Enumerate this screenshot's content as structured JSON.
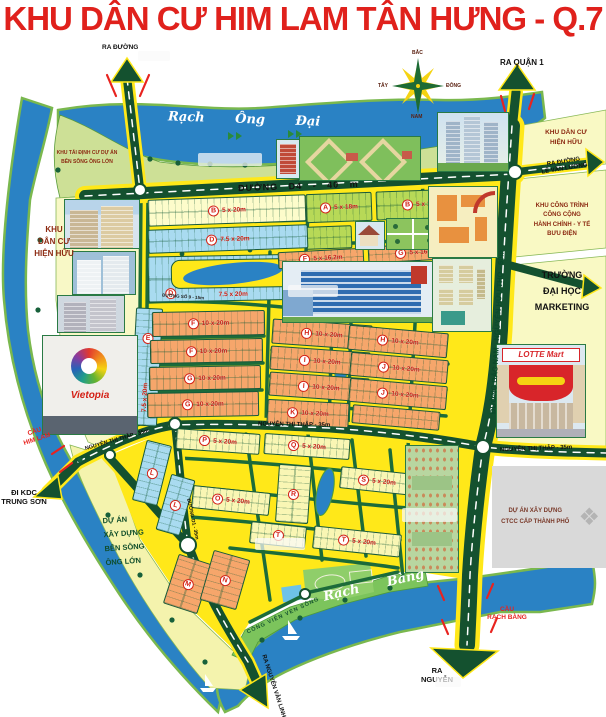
{
  "title": "KHU DÂN CƯ HIM LAM TÂN HƯNG - Q.7",
  "colors": {
    "title_red": "#e0211c",
    "water": "#2a82c4",
    "road_yellow": "#ffe819",
    "road_green": "#14512f",
    "land_green": "#cde096",
    "zone_pale": "#f9f9c4",
    "block_orange": "#f6a66b",
    "block_blue": "#a9dbf0",
    "block_green": "#b7d957"
  },
  "compass": {
    "n": "BẮC",
    "s": "NAM",
    "w": "TÂY",
    "e": "ĐÔNG"
  },
  "waterways": {
    "rach_ong_dai": "Rạch Ông Đại",
    "song_ong_lon": "Sông Ông Lớn",
    "rach_bang": "Rạch Bàng"
  },
  "roads": {
    "d4": "ĐƯỜNG D4 - 40 m",
    "bac_nam": "ĐƯỜNG BẮC NAM - NGUYỄN HỮU THỌ - 60m",
    "ntt": "NGUYỄN THỊ THẬP - 35m",
    "d1": "ĐƯỜNG D1 - 35m",
    "so9": "ĐƯỜNG SỐ 9 - 15m"
  },
  "exits": {
    "quan1": "RA QUẬN 1",
    "lvl": "RA ĐƯỜNG\nLÊ VĂN LƯƠNG",
    "top_left": "RA ĐƯỜNG",
    "kdc_trung_son": "ĐI KDC\nTRUNG SƠN",
    "nvl": "RA NGUYỄN VĂN LINH",
    "nguyen": "RA\nNGUYỄN"
  },
  "bridges": {
    "him_lam": "CẦU\nHIM LAM",
    "rach_bang": "CẦU\nRẠCH BÀNG"
  },
  "areas": {
    "hien_huu_left": "KHU\nDÂN CƯ\nHIỆN HỮU",
    "hien_huu_tr": "KHU DÂN CƯ\nHIỆN HỮU",
    "tai_dinh_cu": "KHU TÁI ĐỊNH CƯ DỰ ÁN\nBÊN SÔNG ÔNG LỚN",
    "cong_trinh": "KHU CÔNG TRÌNH\nCÔNG CỘNG\nHÀNH CHÍNH - Y TẾ\nBƯU ĐIỆN",
    "truong": "TRƯỜNG\nĐẠI HỌC\nMARKETING",
    "du_an_ben_song": "DỰ ÁN\nXÂY DỰNG\nBÊN SÔNG\nÔNG LỚN",
    "ctcc": "DỰ ÁN XÂY DỰNG\nCTCC CẤP THÀNH PHỐ",
    "cong_vien": "CÔNG VIÊN VEN SÔNG"
  },
  "landmarks": {
    "vietopia": "Vietopia",
    "lotte": "LOTTE Mart"
  },
  "blocks": [
    {
      "letter": "B",
      "size": "5 x 20m",
      "color": "paleyellow",
      "x": 148,
      "y": 197,
      "w": 158,
      "h": 27,
      "rot": -2
    },
    {
      "letter": "A",
      "size": "5 x 18m",
      "color": "green",
      "x": 306,
      "y": 193,
      "w": 66,
      "h": 29,
      "rot": -2
    },
    {
      "letter": "B",
      "size": "5 x 18m",
      "color": "green",
      "x": 376,
      "y": 190,
      "w": 90,
      "h": 29,
      "rot": -2
    },
    {
      "letter": "",
      "size": "",
      "color": "green",
      "x": 306,
      "y": 226,
      "w": 46,
      "h": 23,
      "rot": -2
    },
    {
      "letter": "D",
      "size": "7.5 x 20m",
      "color": "blue",
      "x": 148,
      "y": 227,
      "w": 160,
      "h": 24,
      "rot": -2
    },
    {
      "letter": "D",
      "size": "7.5 x 20m",
      "color": "blue",
      "x": 148,
      "y": 255,
      "w": 170,
      "h": 46,
      "rot": -1,
      "lake": true,
      "badge2": "D"
    },
    {
      "letter": "F",
      "size": "5 x 16.2m",
      "color": "orange",
      "x": 278,
      "y": 250,
      "w": 86,
      "h": 17,
      "rot": -3
    },
    {
      "letter": "G",
      "size": "5 x 16.2m",
      "color": "orange",
      "x": 368,
      "y": 244,
      "w": 98,
      "h": 17,
      "rot": -3
    },
    {
      "letter": "E",
      "size": "7.5 x 20m",
      "color": "blue",
      "x": 133,
      "y": 308,
      "w": 27,
      "h": 118,
      "rot": 3,
      "dir": "v"
    },
    {
      "letter": "F",
      "size": "10 x 20m",
      "color": "orange",
      "x": 152,
      "y": 311,
      "w": 113,
      "h": 25,
      "rot": -1
    },
    {
      "letter": "F",
      "size": "10 x 20m",
      "color": "orange",
      "x": 150,
      "y": 339,
      "w": 113,
      "h": 24,
      "rot": -1
    },
    {
      "letter": "G",
      "size": "10 x 20m",
      "color": "orange",
      "x": 149,
      "y": 366,
      "w": 112,
      "h": 24,
      "rot": -1
    },
    {
      "letter": "G",
      "size": "10 x 20m",
      "color": "orange",
      "x": 147,
      "y": 392,
      "w": 112,
      "h": 25,
      "rot": -1
    },
    {
      "letter": "H",
      "size": "10 x 20m",
      "color": "orange",
      "x": 272,
      "y": 322,
      "w": 100,
      "h": 25,
      "rot": 4
    },
    {
      "letter": "I",
      "size": "10 x 20m",
      "color": "orange",
      "x": 270,
      "y": 349,
      "w": 100,
      "h": 24,
      "rot": 4
    },
    {
      "letter": "I",
      "size": "10 x 20m",
      "color": "orange",
      "x": 269,
      "y": 375,
      "w": 100,
      "h": 24,
      "rot": 4
    },
    {
      "letter": "K",
      "size": "10 x 20m",
      "color": "orange",
      "x": 267,
      "y": 401,
      "w": 82,
      "h": 25,
      "rot": 3
    },
    {
      "letter": "H",
      "size": "10 x 20m",
      "color": "orange",
      "x": 348,
      "y": 329,
      "w": 100,
      "h": 25,
      "rot": 5
    },
    {
      "letter": "J",
      "size": "10 x 20m",
      "color": "orange",
      "x": 350,
      "y": 356,
      "w": 98,
      "h": 24,
      "rot": 5
    },
    {
      "letter": "J",
      "size": "10 x 20m",
      "color": "orange",
      "x": 349,
      "y": 382,
      "w": 98,
      "h": 24,
      "rot": 5
    },
    {
      "letter": "",
      "size": "",
      "color": "orange",
      "x": 352,
      "y": 408,
      "w": 88,
      "h": 19,
      "rot": 5
    },
    {
      "letter": "P",
      "size": "5 x 20m",
      "color": "lightyellow",
      "x": 176,
      "y": 431,
      "w": 84,
      "h": 21,
      "rot": 4
    },
    {
      "letter": "Q",
      "size": "5 x 20m",
      "color": "lightyellow",
      "x": 264,
      "y": 436,
      "w": 86,
      "h": 21,
      "rot": 4
    },
    {
      "letter": "L",
      "size": "",
      "color": "blue",
      "x": 139,
      "y": 442,
      "w": 26,
      "h": 62,
      "rot": 14,
      "dir": "v"
    },
    {
      "letter": "L",
      "size": "",
      "color": "blue",
      "x": 163,
      "y": 476,
      "w": 25,
      "h": 58,
      "rot": 16,
      "dir": "v"
    },
    {
      "letter": "O",
      "size": "5 x 20m",
      "color": "lightyellow",
      "x": 192,
      "y": 489,
      "w": 78,
      "h": 23,
      "rot": 6
    },
    {
      "letter": "R",
      "size": "",
      "color": "lightyellow",
      "x": 277,
      "y": 465,
      "w": 33,
      "h": 58,
      "rot": 4,
      "dir": "v"
    },
    {
      "letter": "S",
      "size": "5 x 20m",
      "color": "lightyellow",
      "x": 340,
      "y": 470,
      "w": 74,
      "h": 22,
      "rot": 6
    },
    {
      "letter": "T",
      "size": "",
      "color": "lightyellow",
      "x": 250,
      "y": 524,
      "w": 56,
      "h": 22,
      "rot": 6
    },
    {
      "letter": "T",
      "size": "5 x 20m",
      "color": "lightyellow",
      "x": 313,
      "y": 530,
      "w": 88,
      "h": 23,
      "rot": 6
    },
    {
      "letter": "M",
      "size": "",
      "color": "orange",
      "x": 170,
      "y": 558,
      "w": 36,
      "h": 52,
      "rot": 18,
      "dir": "v"
    },
    {
      "letter": "N",
      "size": "",
      "color": "orange",
      "x": 206,
      "y": 554,
      "w": 38,
      "h": 52,
      "rot": 16,
      "dir": "v"
    }
  ]
}
